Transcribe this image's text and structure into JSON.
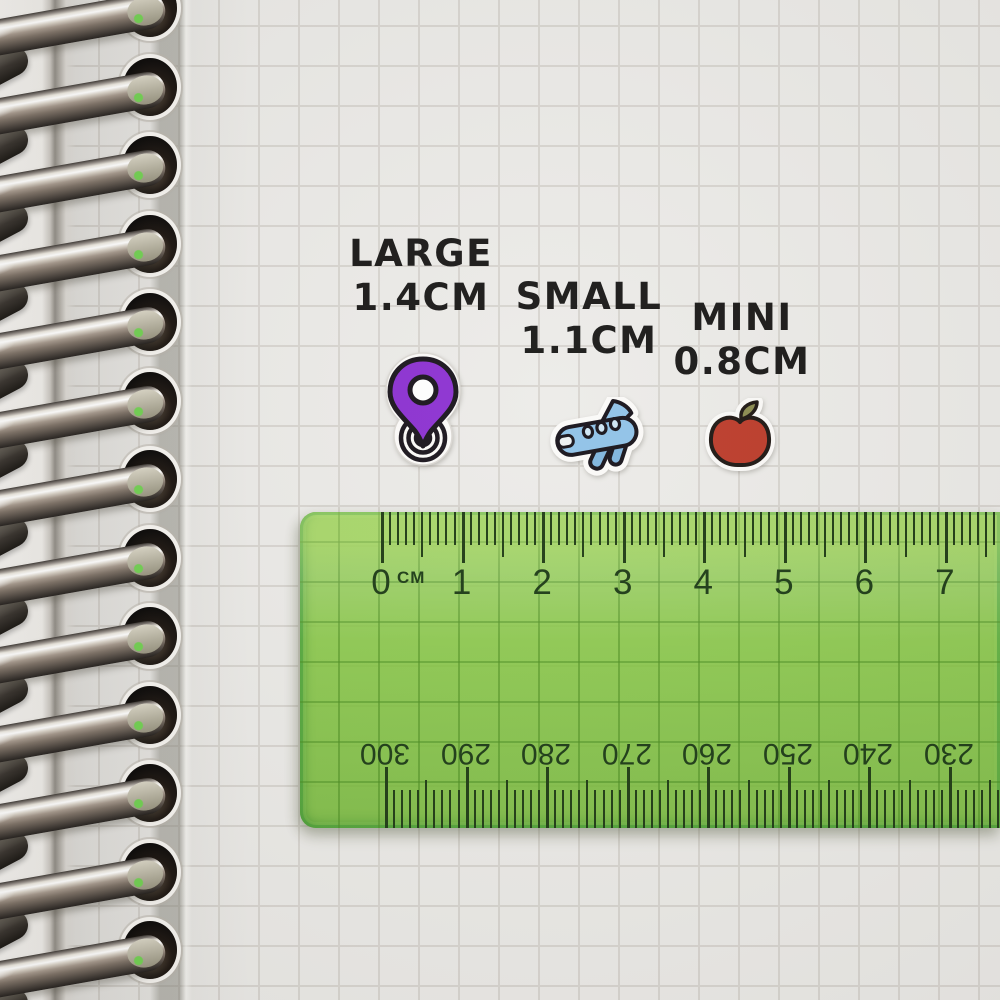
{
  "labels": {
    "large": {
      "name": "LARGE",
      "size": "1.4CM"
    },
    "small": {
      "name": "SMALL",
      "size": "1.1CM"
    },
    "mini": {
      "name": "MINI",
      "size": "0.8CM"
    }
  },
  "stickers": {
    "large": {
      "icon": "location-pin",
      "color": "#8b2fd1"
    },
    "small": {
      "icon": "airplane",
      "color": "#8fc2e8"
    },
    "mini": {
      "icon": "apple",
      "color": "#bc3a28"
    }
  },
  "ruler": {
    "unit": "CM",
    "cm_labels": [
      "0",
      "1",
      "2",
      "3",
      "4",
      "5",
      "6",
      "7"
    ],
    "mm_labels": [
      "300",
      "290",
      "280",
      "270",
      "260",
      "250",
      "240",
      "230"
    ],
    "colors": {
      "body": "#8cc64b",
      "ticks": "#1d3a12"
    }
  },
  "notebook": {
    "ring_count": 13,
    "paper_color": "#ecebe8",
    "grid_color": "#d8d5d0"
  }
}
